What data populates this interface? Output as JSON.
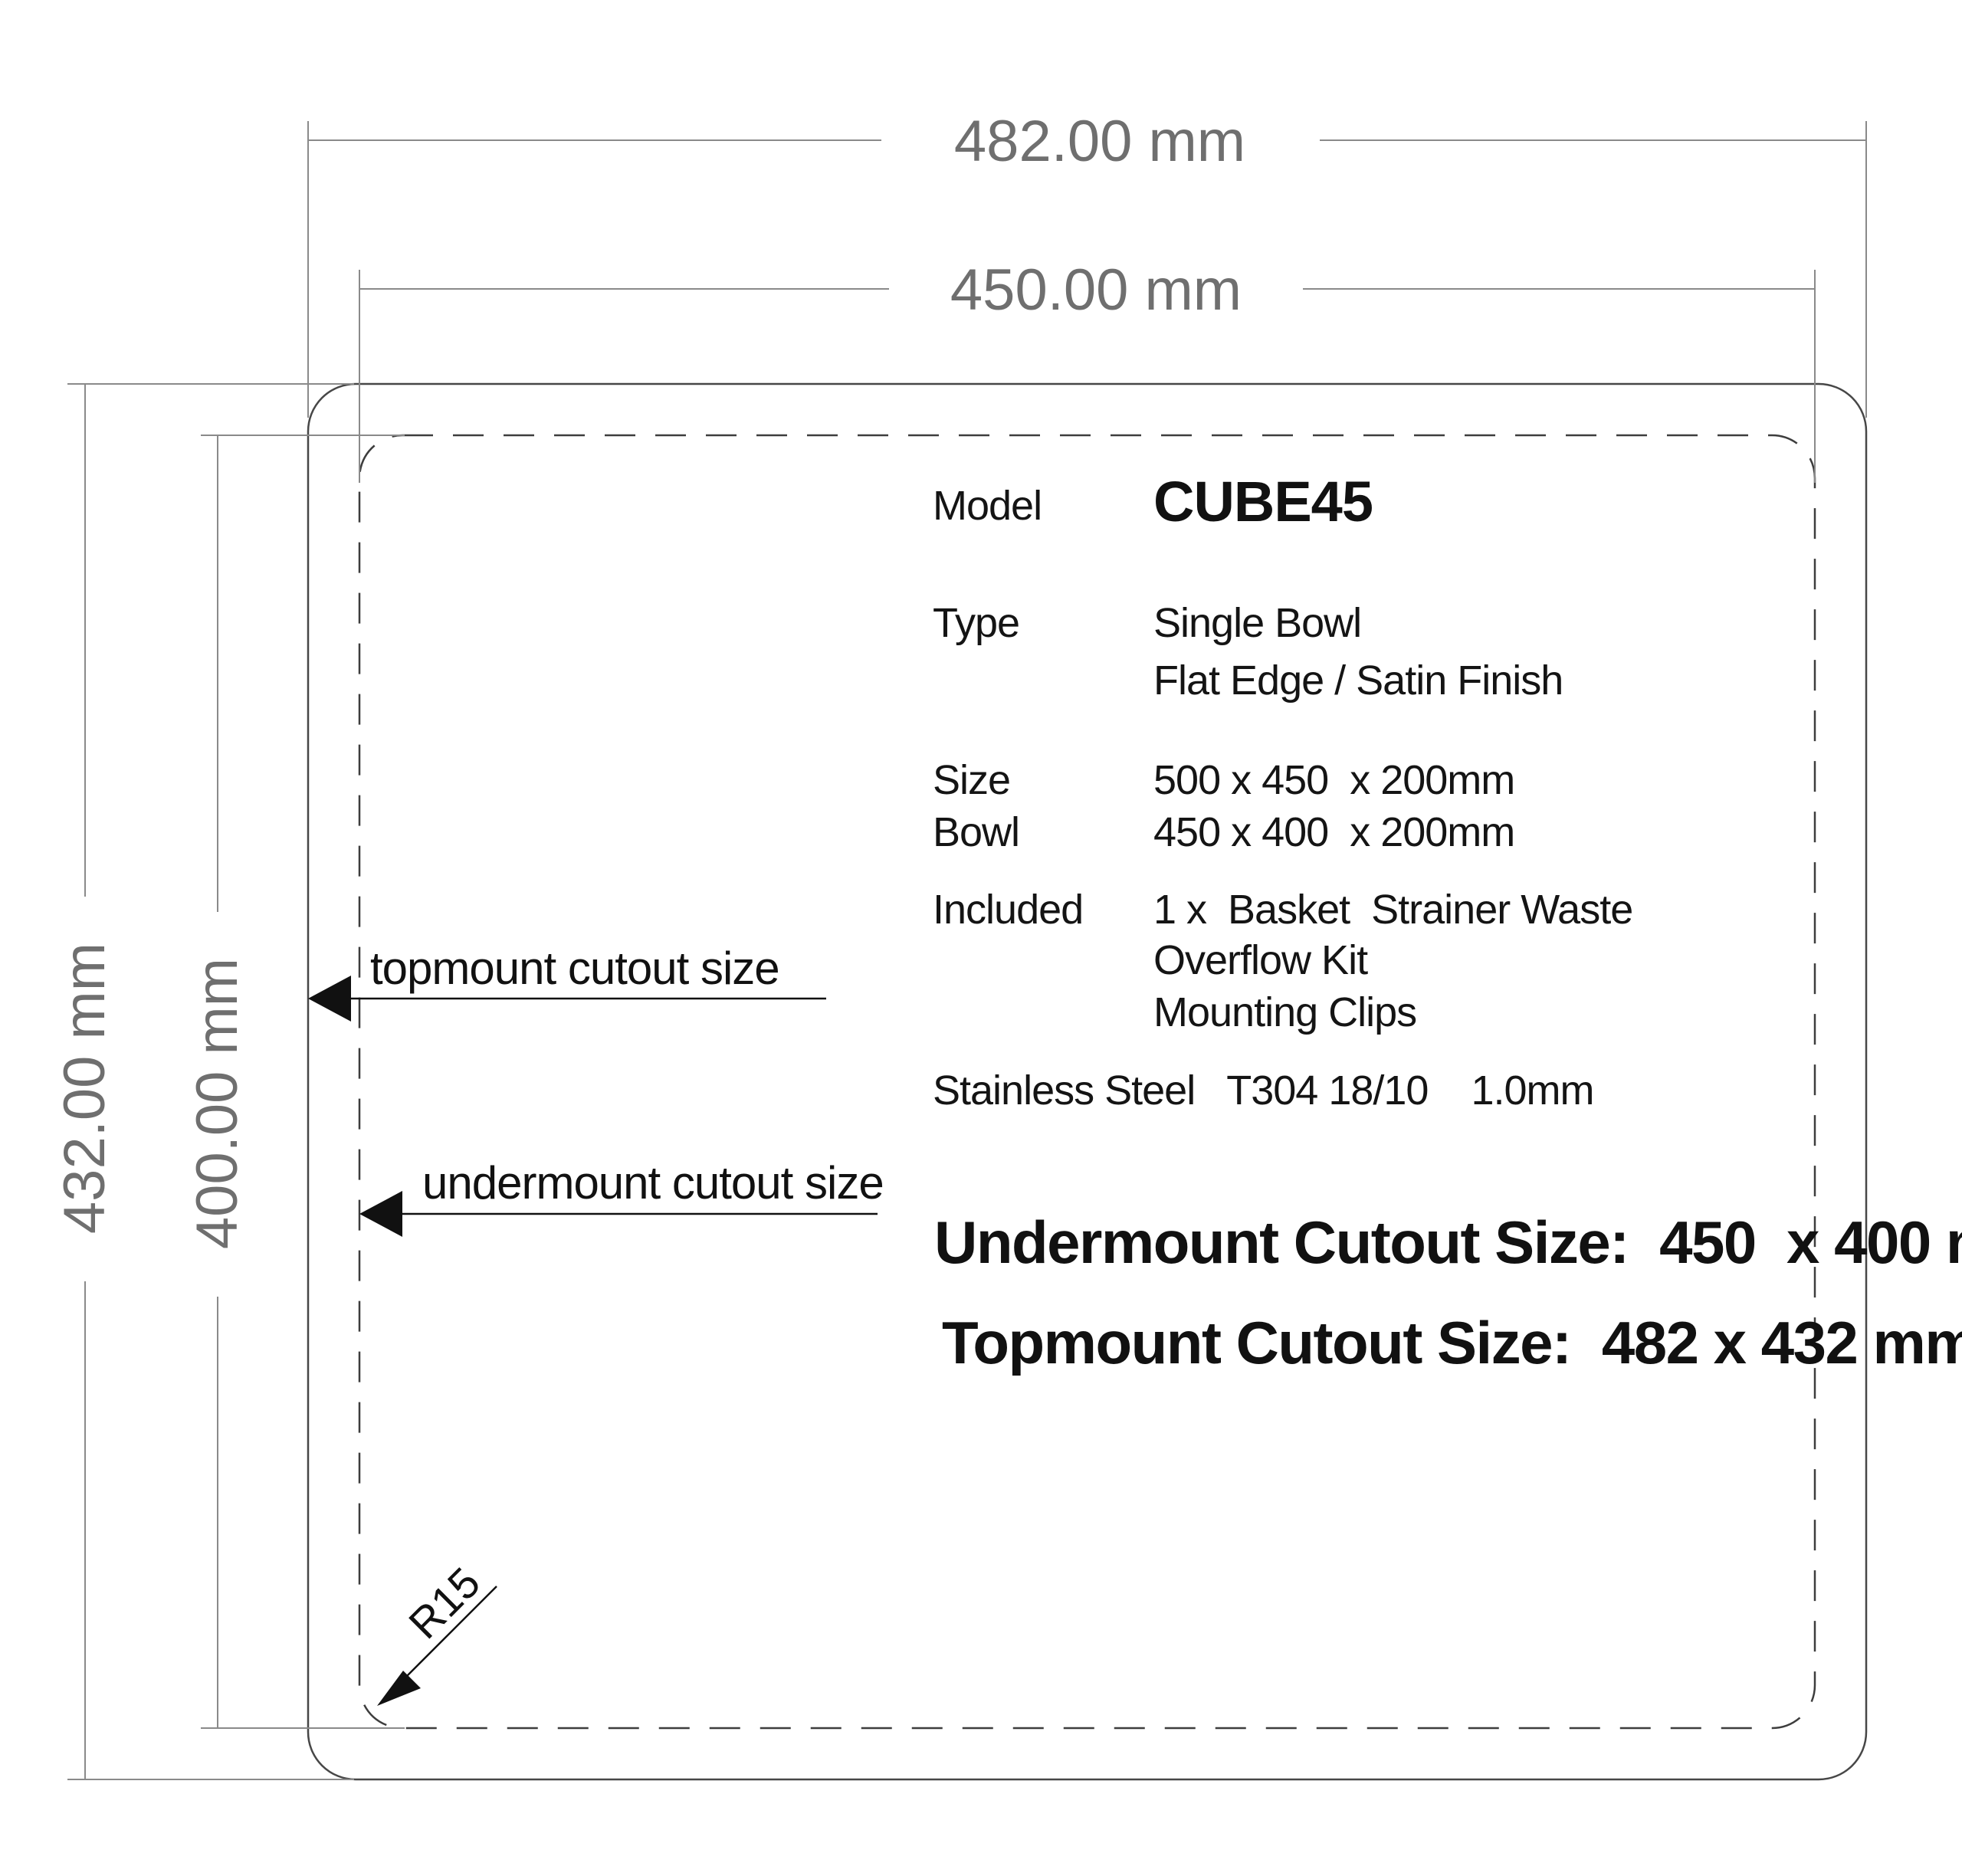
{
  "dimensions": {
    "top_outer": "482.00 mm",
    "top_inner": "450.00 mm",
    "left_outer": "432.00 mm",
    "left_inner": "400.00 mm",
    "corner_radius": "R15"
  },
  "callouts": {
    "topmount": "topmount cutout size",
    "undermount": "undermount cutout size"
  },
  "spec": {
    "model_label": "Model",
    "model_value": "CUBE45",
    "type_label": "Type",
    "type_value_line1": "Single Bowl",
    "type_value_line2": "Flat Edge / Satin Finish",
    "size_label": "Size",
    "size_value": "500 x 450  x 200mm",
    "bowl_label": "Bowl",
    "bowl_value": "450 x 400  x 200mm",
    "included_label": "Included",
    "included_items": [
      "1 x  Basket  Strainer Waste",
      "Overflow Kit",
      "Mounting Clips"
    ],
    "material": "Stainless Steel   T304 18/10    1.0mm"
  },
  "summary": {
    "undermount": "Undermount Cutout Size:  450  x 400 mm",
    "topmount": "Topmount Cutout Size:  482 x 432 mm"
  },
  "colors": {
    "dimension_gray": "#8a8a8a",
    "dimension_text_gray": "#6f6f6f",
    "outline_dark": "#474747",
    "annotation_black": "#111111",
    "background": "#ffffff"
  }
}
